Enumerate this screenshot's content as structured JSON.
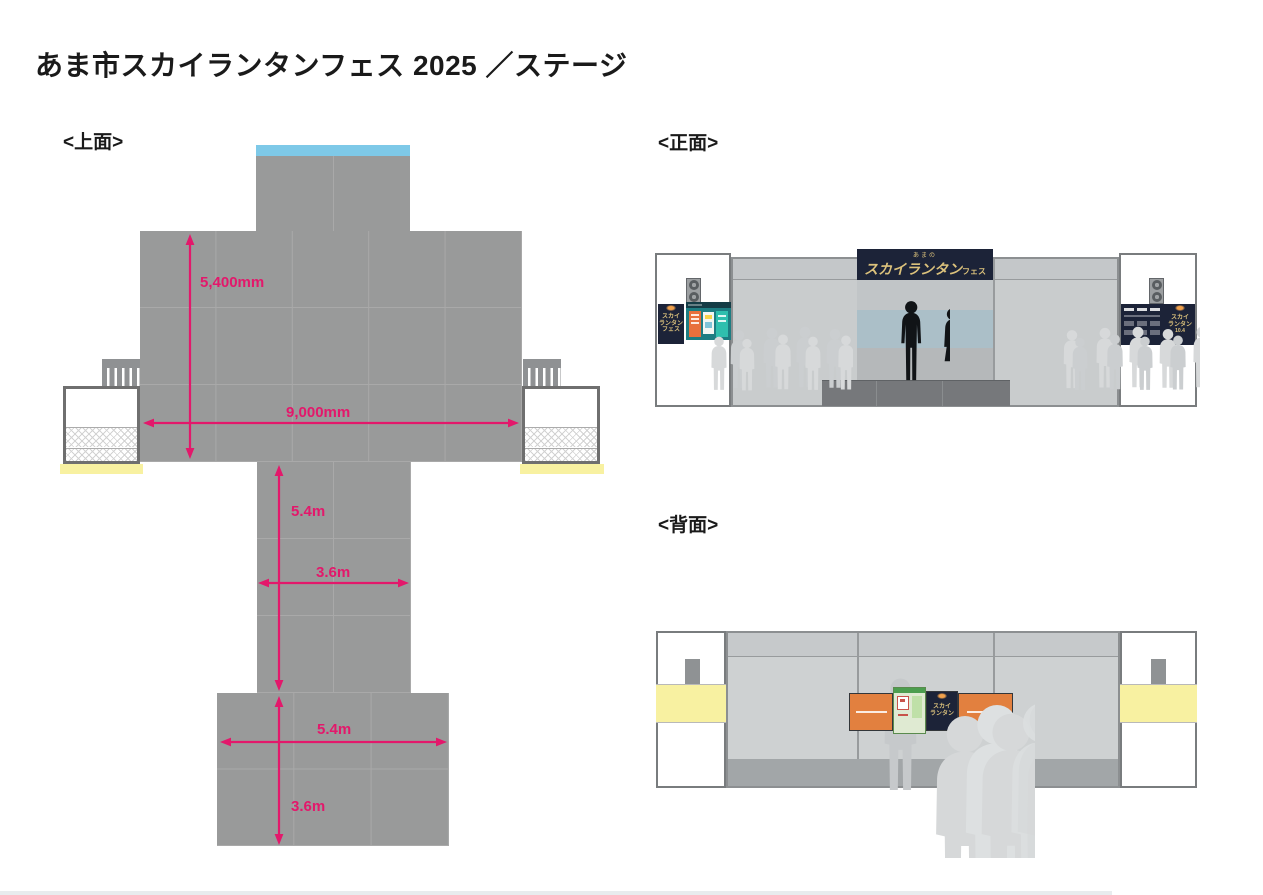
{
  "title": "あま市スカイランタンフェス 2025 ／ステージ",
  "top_view": {
    "label": "<上面>",
    "stage_depth": "5,400mm",
    "stage_width": "9,000mm",
    "runway_length": "5.4m",
    "runway_width": "3.6m",
    "platform_width": "5.4m",
    "platform_depth": "3.6m"
  },
  "front_view": {
    "label": "<正面>",
    "sign": {
      "small": "あまの",
      "main": "スカイランタン",
      "suffix": "フェス"
    },
    "side_banner": {
      "line1": "スカイ",
      "line2": "ランタン",
      "line3": "フェス",
      "date": "10.4"
    }
  },
  "back_view": {
    "label": "<背面>",
    "mini_banner": {
      "line1": "スカイ",
      "line2": "ランタン"
    }
  },
  "colors": {
    "dimension_pink": "#e3186b",
    "stage_gray": "#999a9a",
    "truss_blue": "#7ec9e8",
    "stair_yellow": "#f8f1a1",
    "sign_navy": "#1c2338",
    "sign_gold": "#dcc27c",
    "poster_orange": "#e2803f"
  }
}
